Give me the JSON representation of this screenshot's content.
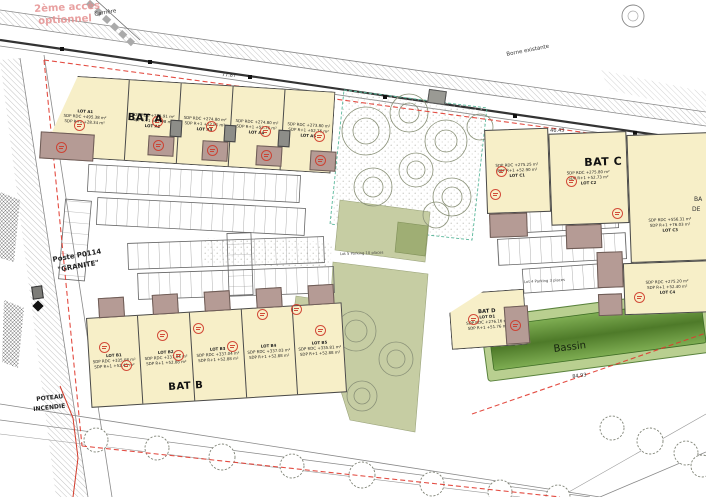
{
  "buildings": {
    "bat_a": {
      "label": "BAT A",
      "lots": [
        {
          "name": "LOT A1",
          "rdc": "SDP RDC +495.38 m²",
          "r1": "SDP R+1 +28.34 m²"
        },
        {
          "name": "LOT A2",
          "rdc": "SDP RDC +274.91 m²",
          "r1": "SDP R+1 +52.98 m²"
        },
        {
          "name": "LOT A3",
          "rdc": "SDP RDC +274.80 m²",
          "r1": "SDP R+1 +52.91 m²"
        },
        {
          "name": "LOT A4",
          "rdc": "SDP RDC +274.80 m²",
          "r1": "SDP R+1 +52.76 m²"
        },
        {
          "name": "LOT A5",
          "rdc": "SDP RDC +273.80 m²",
          "r1": "SDP R+1 +52.76 m²"
        }
      ]
    },
    "bat_b": {
      "label": "BAT B",
      "lots": [
        {
          "name": "LOT B1",
          "rdc": "SDP RDC +335.08 m²",
          "r1": "SDP R+1 +52.45 m²"
        },
        {
          "name": "LOT B2",
          "rdc": "SDP RDC +337.04 m²",
          "r1": "SDP R+1 +52.88 m²"
        },
        {
          "name": "LOT B3",
          "rdc": "SDP RDC +337.04 m²",
          "r1": "SDP R+1 +52.88 m²"
        },
        {
          "name": "LOT B4",
          "rdc": "SDP RDC +337.03 m²",
          "r1": "SDP R+1 +52.88 m²"
        },
        {
          "name": "LOT B5",
          "rdc": "SDP RDC +335.81 m²",
          "r1": "SDP R+1 +52.88 m²"
        }
      ]
    },
    "bat_c": {
      "label": "BAT C",
      "lots": [
        {
          "name": "LOT C1",
          "rdc": "SDP RDC +275.25 m²",
          "r1": "SDP R+1 +52.90 m²"
        },
        {
          "name": "LOT C2",
          "rdc": "SDP RDC +275.80 m²",
          "r1": "SDP R+1 +52.73 m²"
        },
        {
          "name": "LOT C3",
          "rdc": "SDP RDC +556.31 m²",
          "r1": "SDP R+1 +76.03 m²"
        },
        {
          "name": "LOT C4",
          "rdc": "SDP RDC +275.20 m²",
          "r1": "SDP R+1 +52.40 m²"
        }
      ]
    },
    "bat_d": {
      "label": "BAT D",
      "lots": [
        {
          "name": "LOT D1",
          "rdc": "SDP RDC +276.16 m²",
          "r1": "SDP R+1 +51.76 m²"
        }
      ]
    }
  },
  "labels": {
    "bassin": "Bassin",
    "acces_line1": "2ème accès",
    "acces_line2": "optionnel",
    "carriere": "Carrière",
    "borne_existante": "Borne existante",
    "poste_line1": "Poste P0114",
    "poste_line2": "\"GRANITE\"",
    "poteau_line1": "POTEAU",
    "poteau_line2": "INCENDIE",
    "parking_lot5": "Lot 5 Parking 10 places",
    "parking_lot4": "Lot 4 Parking 3 places",
    "edge_partial_1": "BA",
    "edge_partial_2": "DE"
  },
  "dimensions": {
    "top_bat_a": "77.87",
    "top_bat_c": "46.43",
    "bassin_length": "84.93"
  },
  "colors": {
    "building_fill": "#f7efc8",
    "patio_fill": "#b59b95",
    "boundary_red": "#e03a2f",
    "stamp_red": "#cf3a2a",
    "green_area": "#c6cda3",
    "basin_outer": "#b9cf90",
    "basin_inner": "#4e7a29"
  }
}
